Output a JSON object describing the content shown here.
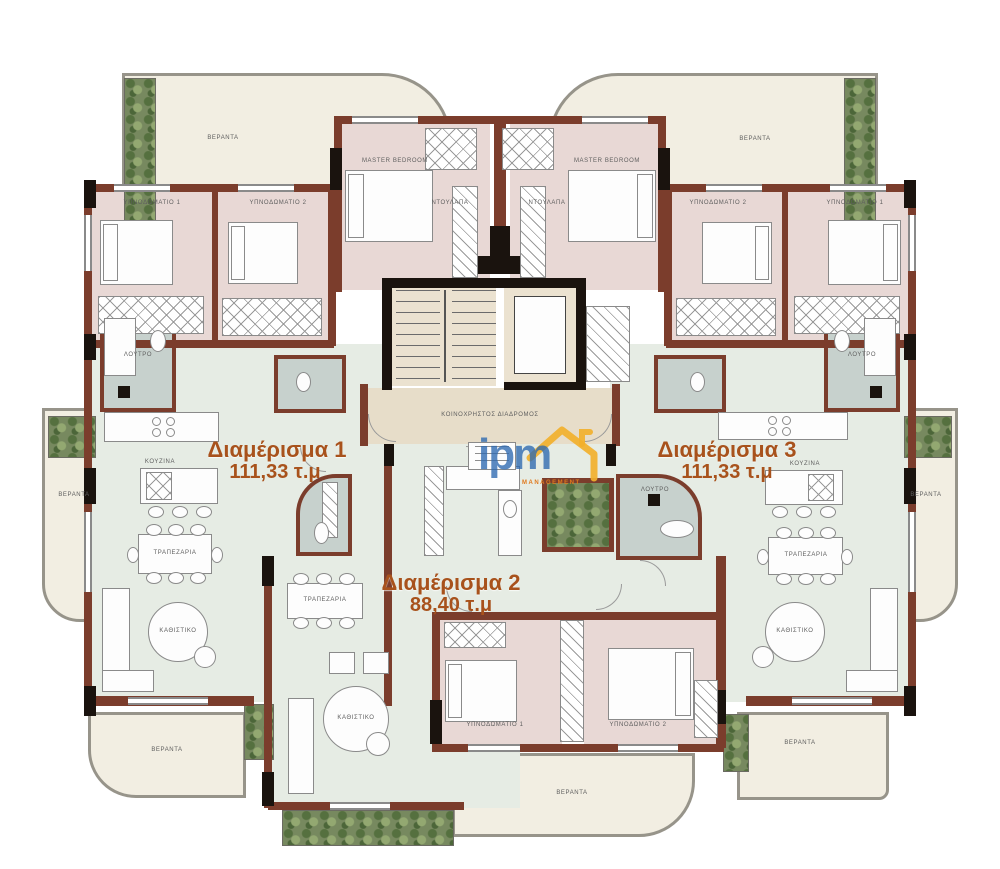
{
  "apartments": [
    {
      "name": "Διαμέρισμα 1",
      "area": "111,33 τ.μ"
    },
    {
      "name": "Διαμέρισμα 2",
      "area": "88,40 τ.μ"
    },
    {
      "name": "Διαμέρισμα 3",
      "area": "111,33 τ.μ"
    }
  ],
  "rooms": {
    "bedroom1": "ΥΠΝΟΔΩΜΑΤΙΟ 1",
    "bedroom2": "ΥΠΝΟΔΩΜΑΤΙΟ 2",
    "master": "MASTER BEDROOM",
    "dining": "ΤΡΑΠΕΖΑΡΙΑ",
    "sitting": "ΚΑΘΙΣΤΙΚΟ",
    "bath": "ΛΟΥΤΡΟ",
    "veranda": "ΒΕΡΑΝΤΑ",
    "wardrobe": "ΝΤΟΥΛΑΠΑ",
    "kitchen": "ΚΟΥΖΙΝΑ",
    "corridor": "ΚΟΙΝΟΧΡΗΣΤΟΣ ΔΙΑΔΡΟΜΟΣ"
  },
  "logo": {
    "text": "ipm",
    "subtext": "MANAGEMENT"
  },
  "colors": {
    "wall": "#7b3d2c",
    "structural": "#1a130e",
    "bedroom_floor": "#e8d8d5",
    "living_floor": "#e6ece4",
    "bath_floor": "#c7d1cd",
    "balcony_floor": "#f2eee2",
    "core_floor": "#ebe2d0",
    "label_accent": "#a8521c",
    "plants": "#77895f",
    "logo_blue": "#2b68b0",
    "logo_yellow": "#f2b02c"
  }
}
